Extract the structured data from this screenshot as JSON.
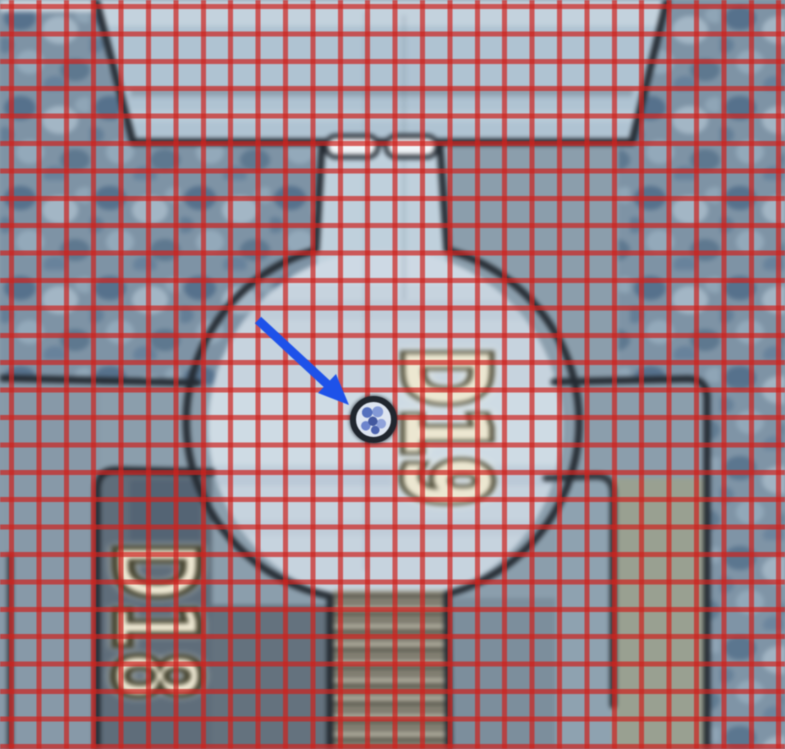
{
  "micrograph": {
    "die_labels": {
      "right": "D19",
      "left_lower": "D18"
    }
  },
  "overlay": {
    "grid": {
      "color_hex": "#cd231e"
    },
    "arrow": {
      "color_hex": "#1e52e9"
    },
    "probe_mark": {
      "ring_color_hex": "#20262e",
      "fill_color_hex": "#dde5f1"
    }
  },
  "palette": {
    "pad_light_hex": "#c6d3de",
    "top_band_hex": "#afc3d2",
    "street_texture_hex": "#7e93a5",
    "outline_hex": "#232930",
    "label_fill_hex": "#ece7d1",
    "label_stroke_hex": "#4e4b37"
  }
}
